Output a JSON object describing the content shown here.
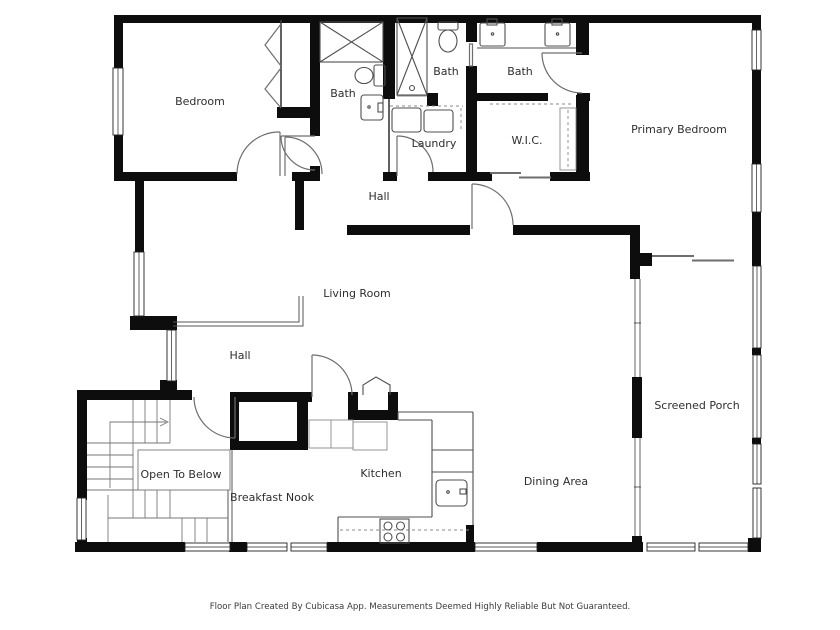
{
  "page": {
    "title": "Floor Plan",
    "background": "#ffffff"
  },
  "colors": {
    "wall": "#0d0d0d",
    "fixture": "#4f4f4f",
    "door": "#6e6e6e",
    "label": "#2e2e2e"
  },
  "rooms": [
    {
      "id": "bedroom",
      "label": "Bedroom"
    },
    {
      "id": "bath-left",
      "label": "Bath"
    },
    {
      "id": "bath-middle",
      "label": "Bath"
    },
    {
      "id": "bath-right",
      "label": "Bath"
    },
    {
      "id": "laundry",
      "label": "Laundry"
    },
    {
      "id": "wic",
      "label": "W.I.C."
    },
    {
      "id": "primary-bedroom",
      "label": "Primary Bedroom"
    },
    {
      "id": "hall-upper",
      "label": "Hall"
    },
    {
      "id": "living-room",
      "label": "Living Room"
    },
    {
      "id": "hall-lower",
      "label": "Hall"
    },
    {
      "id": "open-to-below",
      "label": "Open To Below"
    },
    {
      "id": "breakfast-nook",
      "label": "Breakfast Nook"
    },
    {
      "id": "kitchen",
      "label": "Kitchen"
    },
    {
      "id": "dining-area",
      "label": "Dining Area"
    },
    {
      "id": "screened-porch",
      "label": "Screened Porch"
    }
  ],
  "footer": {
    "text": "Floor Plan Created By Cubicasa App. Measurements Deemed Highly Reliable But Not Guaranteed."
  }
}
